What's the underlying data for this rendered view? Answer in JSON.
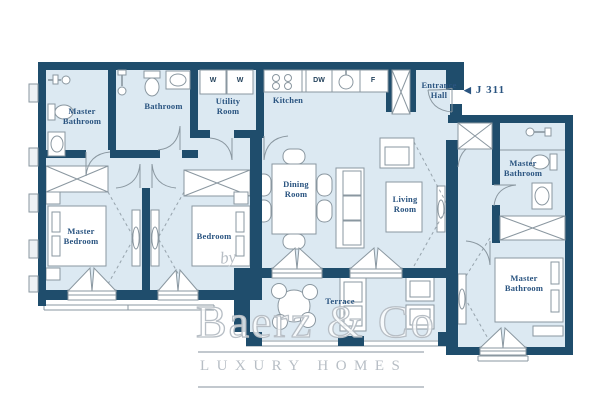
{
  "colors": {
    "wall": "#1F4D6C",
    "floor": "#DCE9F2",
    "line": "#8A97A0",
    "label": "#2A5480",
    "watermark": "#B7BEC5"
  },
  "unit": {
    "arrow": "◀",
    "label": "J 311"
  },
  "rooms": {
    "master_bathroom_left": "Master Bathroom",
    "bathroom": "Bathroom",
    "utility_room": "Utility Room",
    "kitchen": "Kitchen",
    "entrance_hall": "Entrance Hall",
    "dining_room": "Dining Room",
    "living_room": "Living Room",
    "master_bedroom": "Master Bedroom",
    "bedroom": "Bedroom",
    "master_bathroom_right": "Master Bathroom",
    "master_bathroom_bottom": "Master Bathroom",
    "terrace": "Terrace"
  },
  "appliances": {
    "washer_1": "W",
    "washer_2": "W",
    "dishwasher": "DW",
    "fridge": "F"
  },
  "watermark": {
    "by": "by",
    "brand": "Baerz & Co",
    "tagline": "LUXURY HOMES"
  }
}
